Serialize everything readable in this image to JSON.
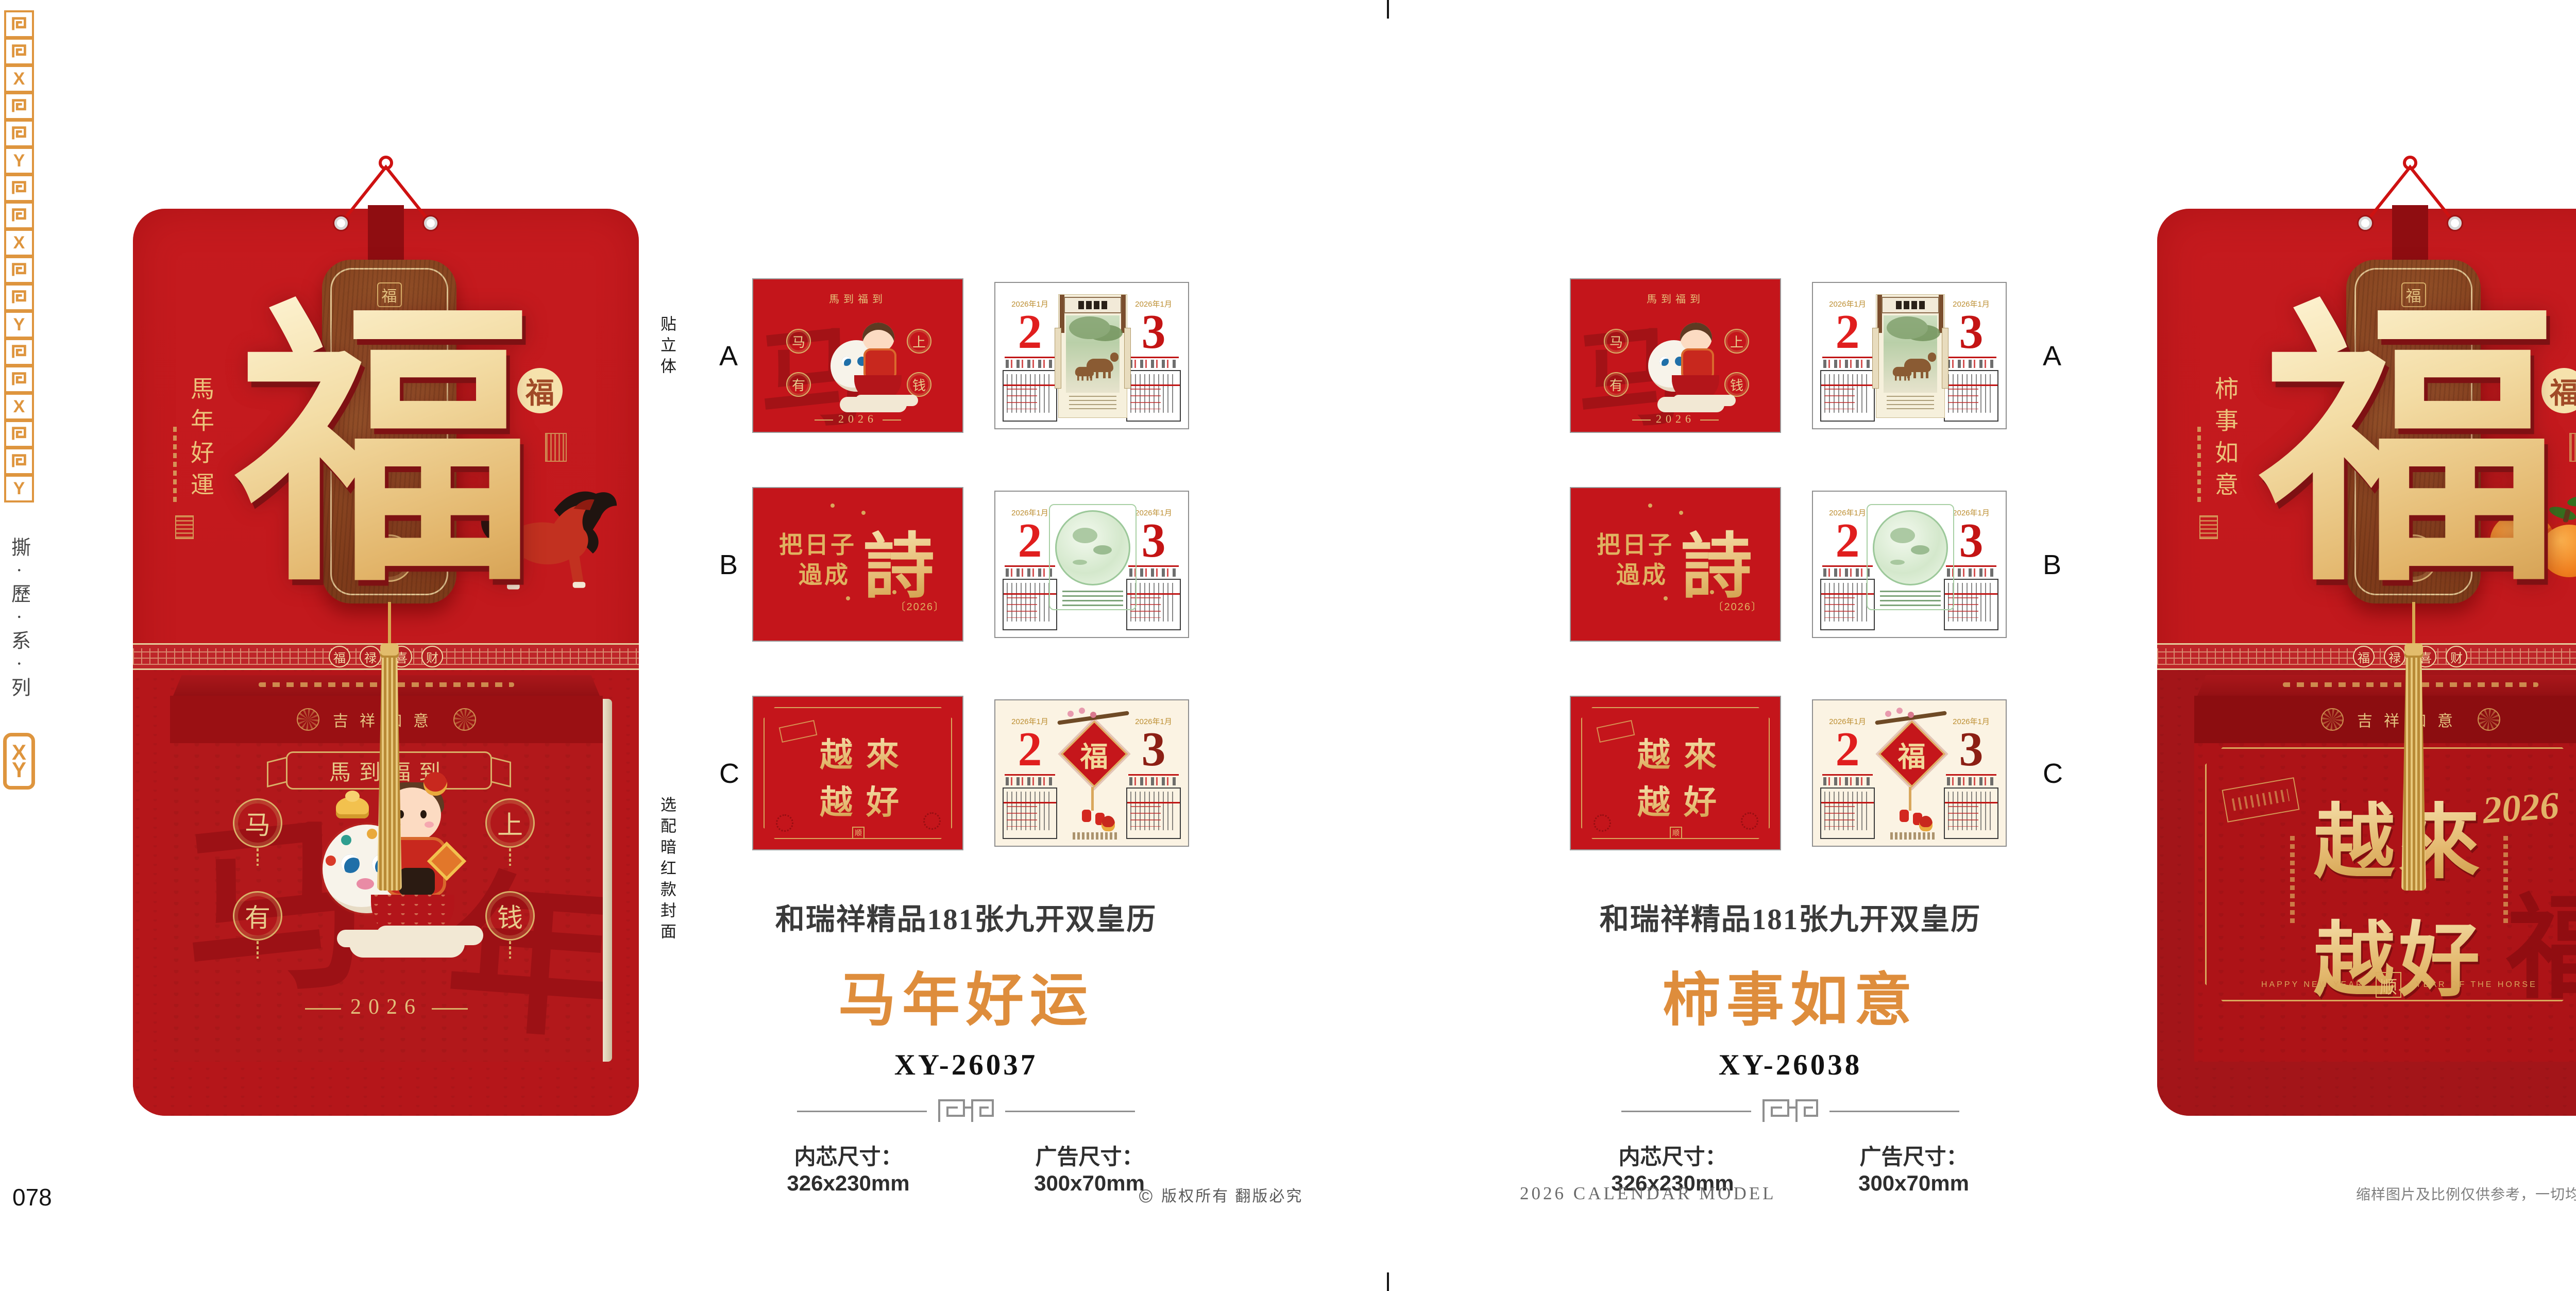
{
  "colors": {
    "red_bright": "#C2191D",
    "red_deep": "#9A1013",
    "red_pouch": "#B5161A",
    "red_face": "#B2181B",
    "gold": "#E3BA72",
    "gold_deep": "#D9A75C",
    "orange_accent": "#DE8D3C",
    "rail_orange": "#DE953E",
    "text_dark": "#3A3A3A",
    "text_gray": "#6F6F6F"
  },
  "rail": {
    "series_vertical": "撕·歷·系·列",
    "logo_x": "X",
    "logo_y": "Y",
    "pattern": [
      "maze",
      "maze",
      "X",
      "maze",
      "maze",
      "Y"
    ]
  },
  "labels": {
    "top": "贴立体",
    "bottom": "选配暗红款封面"
  },
  "calendar_common": {
    "plaque_char": "福",
    "plaque_seal_top": "福",
    "plaque_seal_bottom": "福",
    "badge_char": "福",
    "band_medallions": [
      "福",
      "禄",
      "喜",
      "财"
    ],
    "lid_text": "吉祥如意"
  },
  "calendars": [
    {
      "side_title": "馬年好運",
      "box": {
        "banner": "馬到福到",
        "med": [
          "马",
          "上",
          "有",
          "钱"
        ],
        "year": "2026",
        "watermark": [
          "马",
          "年"
        ]
      }
    },
    {
      "side_title": "柿事如意",
      "box": {
        "chars": [
          "越",
          "來",
          "越",
          "好"
        ],
        "year": "2026",
        "seal": "顺",
        "eng_left": "HAPPY NEW YEAR",
        "eng_right": "YEAR OF THE HORSE",
        "watermark": "福"
      }
    }
  ],
  "thumbs": {
    "letters": [
      "A",
      "B",
      "C"
    ],
    "cover_a": {
      "arc": "馬到福到",
      "med": [
        "马",
        "上",
        "有",
        "钱"
      ],
      "year": "2026",
      "watermark": "马"
    },
    "cover_b": {
      "l1": "把日子",
      "l2": "過成",
      "big": "詩",
      "year": "〔2026〕"
    },
    "cover_c": {
      "chars": [
        "越",
        "來",
        "越",
        "好"
      ],
      "seal": "顺"
    },
    "page": {
      "month": "2026年1月",
      "d2": "2",
      "d3": "3",
      "fu": "福"
    }
  },
  "products": [
    {
      "series": "和瑞祥精品181张九开双皇历",
      "name": "马年好运",
      "model": "XY-26037",
      "spec_core": "内芯尺寸：326x230mm",
      "spec_ad": "广告尺寸：300x70mm"
    },
    {
      "series": "和瑞祥精品181张九开双皇历",
      "name": "柿事如意",
      "model": "XY-26038",
      "spec_core": "内芯尺寸：326x230mm",
      "spec_ad": "广告尺寸：300x70mm"
    }
  ],
  "footer": {
    "page_left": "078",
    "copyright_symbol": "©",
    "copyright": "版权所有 翻版必究",
    "center": "2026 CALENDAR MODEL",
    "disclaimer": "缩样图片及比例仅供参考，一切均以正式样本为实。",
    "page_right": "079"
  }
}
